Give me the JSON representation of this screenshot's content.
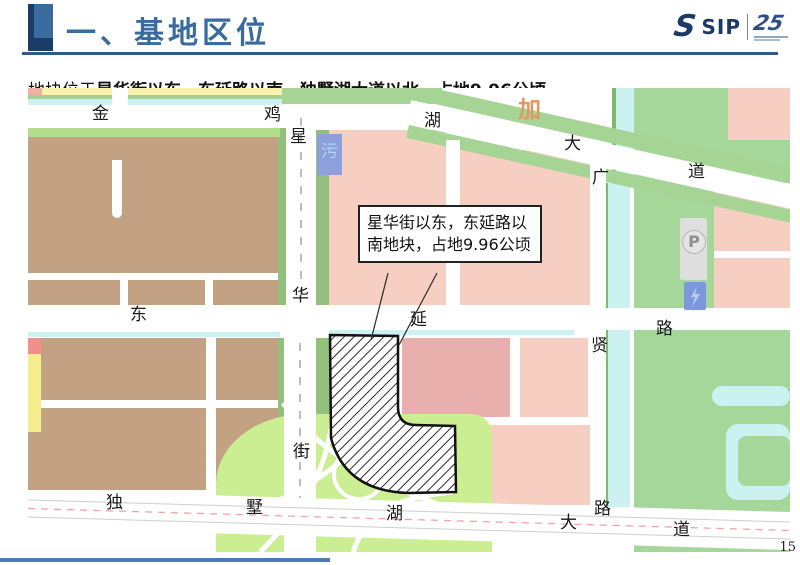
{
  "slide": {
    "title": "一、基地区位",
    "subtitle_prefix": "地块位于",
    "subtitle_emphasis": "星华街以东，东延路以南，独墅湖大道以北，占地9.96公顷。",
    "page_number": "15"
  },
  "logo": {
    "sip": "SIP",
    "anniversary": "25"
  },
  "map": {
    "callout": {
      "text": "星华街以东，东延路以南地块，占地9.96公顷"
    },
    "parcels": {
      "parking": "P",
      "sewage": "污"
    },
    "labels": [
      {
        "t": "金",
        "x": 64,
        "y": 18
      },
      {
        "t": "鸡",
        "x": 236,
        "y": 19
      },
      {
        "t": "星",
        "x": 262,
        "y": 41
      },
      {
        "t": "湖",
        "x": 396,
        "y": 25
      },
      {
        "t": "大",
        "x": 536,
        "y": 48
      },
      {
        "t": "道",
        "x": 660,
        "y": 76
      },
      {
        "t": "加",
        "x": 490,
        "y": 11,
        "c": "#E2975F",
        "s": 23
      },
      {
        "t": "广",
        "x": 564,
        "y": 82
      },
      {
        "t": "华",
        "x": 264,
        "y": 200
      },
      {
        "t": "东",
        "x": 102,
        "y": 219
      },
      {
        "t": "延",
        "x": 382,
        "y": 224
      },
      {
        "t": "路",
        "x": 628,
        "y": 233
      },
      {
        "t": "贤",
        "x": 563,
        "y": 250
      },
      {
        "t": "街",
        "x": 265,
        "y": 356
      },
      {
        "t": "独",
        "x": 78,
        "y": 407
      },
      {
        "t": "墅",
        "x": 218,
        "y": 412
      },
      {
        "t": "湖",
        "x": 358,
        "y": 418
      },
      {
        "t": "路",
        "x": 566,
        "y": 413
      },
      {
        "t": "大",
        "x": 532,
        "y": 427
      },
      {
        "t": "道",
        "x": 645,
        "y": 434
      }
    ]
  },
  "colors": {
    "accent": "#3A6B9F",
    "navy": "#1C3C68",
    "rule": "#2F5A8C",
    "brown_block": "#C3A283",
    "pink_block": "#F7CFC2",
    "dark_pink_block": "#E8AFAD",
    "green_strip": "#A5D494",
    "light_green_interchange": "#CBEE92",
    "canal_cyan": "#CBF1F1",
    "blue_parcel": "#7D97DB",
    "site_border": "#111111"
  }
}
